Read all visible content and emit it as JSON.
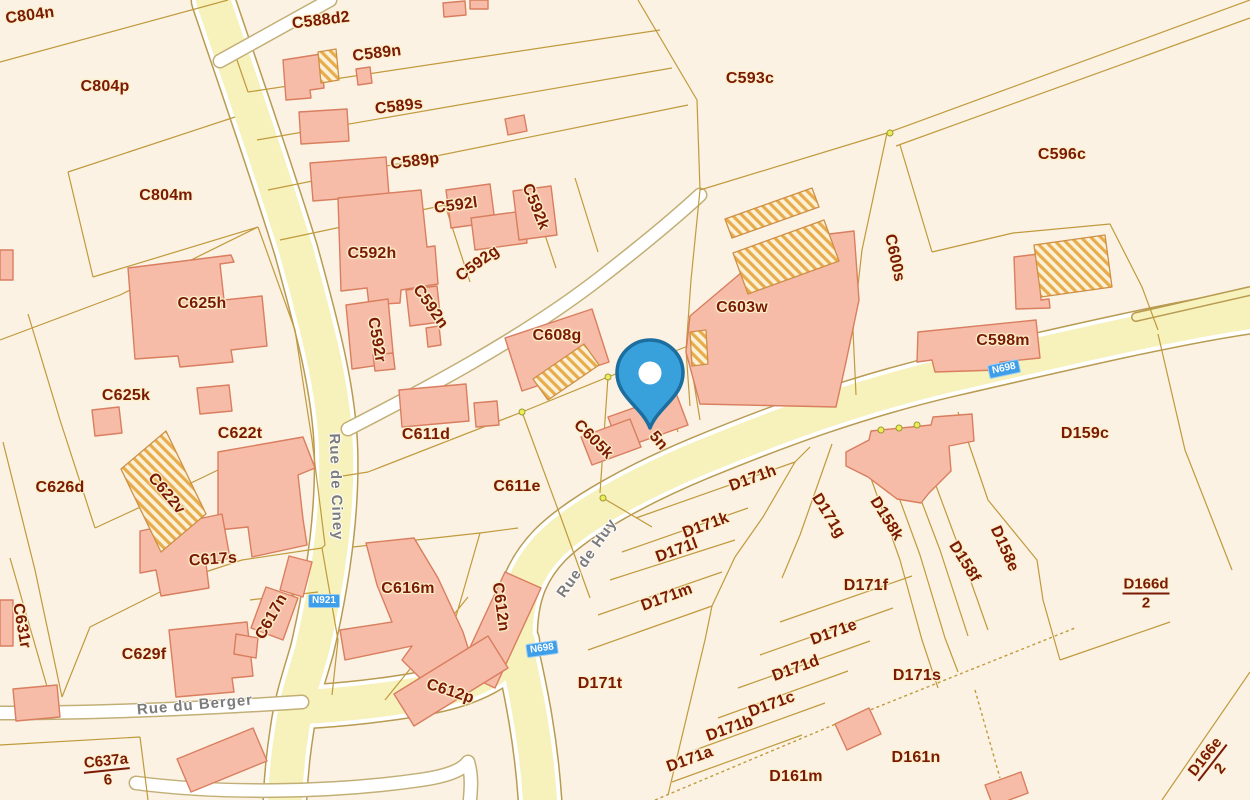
{
  "map": {
    "colors": {
      "background": "#FBF2E4",
      "road_fill": "#F7F1BB",
      "road_edge": "#B89B51",
      "white_road": "#FFFFFF",
      "building_fill": "#F6BCA8",
      "building_stroke": "#D97E5F",
      "hatch_line": "#E8AC4A",
      "parcel_line": "#C09A3C",
      "parcel_label_color": "#7A1A04",
      "label_halo": "#FCEFCB",
      "street_label_color": "#7B7B7B",
      "badge_background": "#3E9EE8",
      "pin_fill": "#38A1DB",
      "pin_stroke": "#1B6E9E"
    },
    "parcel_labels": [
      {
        "text": "C804n",
        "x": 30,
        "y": 16,
        "rot": -8
      },
      {
        "text": "C804p",
        "x": 105,
        "y": 87,
        "rot": 0
      },
      {
        "text": "C804m",
        "x": 166,
        "y": 196,
        "rot": 0
      },
      {
        "text": "C588d2",
        "x": 321,
        "y": 21,
        "rot": -7
      },
      {
        "text": "C589n",
        "x": 377,
        "y": 54,
        "rot": -7
      },
      {
        "text": "C589s",
        "x": 399,
        "y": 107,
        "rot": -7
      },
      {
        "text": "C589p",
        "x": 415,
        "y": 162,
        "rot": -7
      },
      {
        "text": "C592l",
        "x": 456,
        "y": 206,
        "rot": -8
      },
      {
        "text": "C592k",
        "x": 535,
        "y": 207,
        "rot": 68
      },
      {
        "text": "C592h",
        "x": 372,
        "y": 254,
        "rot": 0
      },
      {
        "text": "C592g",
        "x": 478,
        "y": 264,
        "rot": -36
      },
      {
        "text": "C592r",
        "x": 376,
        "y": 340,
        "rot": 80
      },
      {
        "text": "C592n",
        "x": 430,
        "y": 307,
        "rot": 55
      },
      {
        "text": "C593c",
        "x": 750,
        "y": 79,
        "rot": 0
      },
      {
        "text": "C596c",
        "x": 1062,
        "y": 155,
        "rot": 0
      },
      {
        "text": "C600s",
        "x": 894,
        "y": 258,
        "rot": 78
      },
      {
        "text": "C603w",
        "x": 742,
        "y": 308,
        "rot": 0
      },
      {
        "text": "C598m",
        "x": 1003,
        "y": 341,
        "rot": 0
      },
      {
        "text": "C625h",
        "x": 202,
        "y": 304,
        "rot": 0
      },
      {
        "text": "C625k",
        "x": 126,
        "y": 396,
        "rot": 0
      },
      {
        "text": "C622t",
        "x": 240,
        "y": 434,
        "rot": 0
      },
      {
        "text": "C622v",
        "x": 166,
        "y": 494,
        "rot": 50
      },
      {
        "text": "C626d",
        "x": 60,
        "y": 488,
        "rot": 0
      },
      {
        "text": "C611d",
        "x": 426,
        "y": 435,
        "rot": 0
      },
      {
        "text": "C608g",
        "x": 557,
        "y": 336,
        "rot": 0
      },
      {
        "text": "C605k",
        "x": 593,
        "y": 440,
        "rot": 45
      },
      {
        "text": "5n",
        "x": 658,
        "y": 441,
        "rot": 50
      },
      {
        "text": "C611e",
        "x": 517,
        "y": 487,
        "rot": 0
      },
      {
        "text": "C616m",
        "x": 408,
        "y": 589,
        "rot": 0
      },
      {
        "text": "C612n",
        "x": 500,
        "y": 607,
        "rot": 82
      },
      {
        "text": "C612p",
        "x": 450,
        "y": 692,
        "rot": 18
      },
      {
        "text": "C617s",
        "x": 213,
        "y": 560,
        "rot": -4
      },
      {
        "text": "C617n",
        "x": 272,
        "y": 617,
        "rot": -61
      },
      {
        "text": "C629f",
        "x": 144,
        "y": 655,
        "rot": 0
      },
      {
        "text": "C631r",
        "x": 21,
        "y": 626,
        "rot": 80
      },
      {
        "text": "D159c",
        "x": 1085,
        "y": 434,
        "rot": 0
      },
      {
        "text": "D158k",
        "x": 886,
        "y": 519,
        "rot": 58
      },
      {
        "text": "D158f",
        "x": 964,
        "y": 562,
        "rot": 58
      },
      {
        "text": "D158e",
        "x": 1004,
        "y": 549,
        "rot": 66
      },
      {
        "text": "D171h",
        "x": 753,
        "y": 479,
        "rot": -20
      },
      {
        "text": "D171k",
        "x": 706,
        "y": 526,
        "rot": -20
      },
      {
        "text": "D171l",
        "x": 677,
        "y": 551,
        "rot": -20
      },
      {
        "text": "D171m",
        "x": 667,
        "y": 598,
        "rot": -20
      },
      {
        "text": "D171g",
        "x": 828,
        "y": 516,
        "rot": 58
      },
      {
        "text": "D171f",
        "x": 866,
        "y": 586,
        "rot": 0
      },
      {
        "text": "D171e",
        "x": 834,
        "y": 633,
        "rot": -20
      },
      {
        "text": "D171d",
        "x": 796,
        "y": 669,
        "rot": -20
      },
      {
        "text": "D171c",
        "x": 772,
        "y": 705,
        "rot": -20
      },
      {
        "text": "D171b",
        "x": 730,
        "y": 729,
        "rot": -20
      },
      {
        "text": "D171a",
        "x": 690,
        "y": 760,
        "rot": -20
      },
      {
        "text": "D171t",
        "x": 600,
        "y": 684,
        "rot": 0
      },
      {
        "text": "D171s",
        "x": 917,
        "y": 676,
        "rot": 0
      },
      {
        "text": "D161n",
        "x": 916,
        "y": 758,
        "rot": 0
      },
      {
        "text": "D161m",
        "x": 796,
        "y": 777,
        "rot": 0
      }
    ],
    "fraction_labels": [
      {
        "numerator": "C637a",
        "denominator": "6",
        "x": 107,
        "y": 771,
        "rot": -6
      },
      {
        "numerator": "D166d",
        "denominator": "2",
        "x": 1146,
        "y": 594,
        "rot": 0
      },
      {
        "numerator": "D166e",
        "denominator": "2",
        "x": 1213,
        "y": 763,
        "rot": -52
      }
    ],
    "street_labels": [
      {
        "text": "Rue de Ciney",
        "x": 336,
        "y": 487,
        "rot": 88
      },
      {
        "text": "Rue de Huy",
        "x": 587,
        "y": 558,
        "rot": -55
      },
      {
        "text": "Rue du Berger",
        "x": 195,
        "y": 705,
        "rot": -5
      }
    ],
    "road_badges": [
      {
        "text": "N921",
        "x": 324,
        "y": 601,
        "rot": 0
      },
      {
        "text": "N698",
        "x": 1004,
        "y": 369,
        "rot": -12
      },
      {
        "text": "N698",
        "x": 542,
        "y": 649,
        "rot": -8
      }
    ],
    "marker": {
      "name": "location-pin",
      "x": 650,
      "y": 428
    }
  }
}
